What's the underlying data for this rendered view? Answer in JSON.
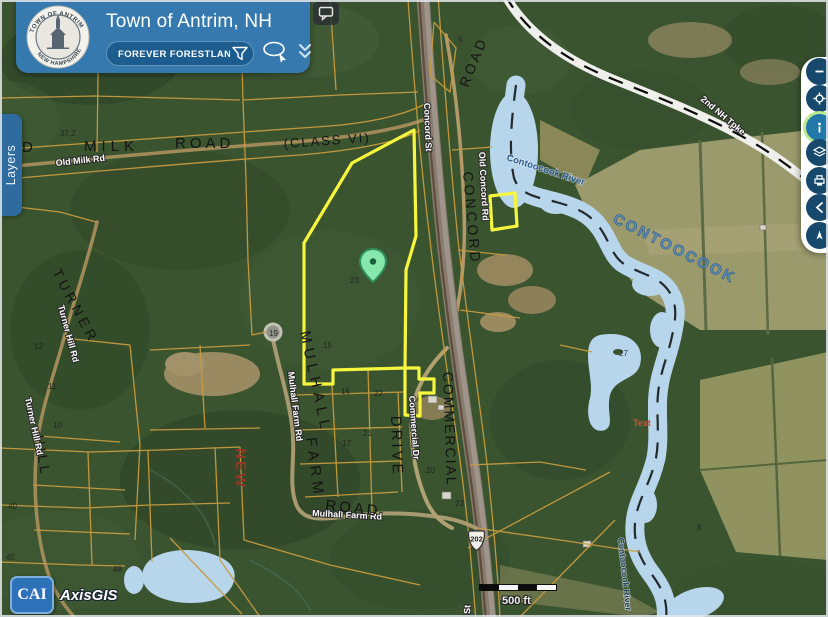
{
  "header": {
    "title": "Town of Antrim, NH",
    "seal": {
      "arc_top": "TOWN OF ANTRIM",
      "arc_bottom": "NEW HAMPSHIRE"
    },
    "search": {
      "value": "FOREVER FORESTLANDS"
    }
  },
  "tabs": {
    "layers": "Layers"
  },
  "icons": [
    "comment",
    "filter-funnel",
    "lasso-select",
    "double-chevron-down",
    "minus",
    "crosshair",
    "info",
    "layers",
    "print",
    "arrow-left",
    "compass",
    "location-pin"
  ],
  "branding": {
    "cai": "CAI",
    "product": "AxisGIS"
  },
  "scale_bar": {
    "label": "500 ft"
  },
  "route_shield": {
    "number": "202"
  },
  "map": {
    "adjacent_town": "ERING",
    "labels": {
      "old": {
        "text": "OLD"
      },
      "milk": {
        "text": "MILK"
      },
      "road_top": {
        "text": "ROAD"
      },
      "class_vi": {
        "text": "(CLASS VI)"
      },
      "old_milk_rd": {
        "text": "Old Milk Rd"
      },
      "concord_st": {
        "text": "Concord St"
      },
      "road_vert": {
        "text": "ROAD"
      },
      "old_concord_rd": {
        "text": "Old Concord Rd"
      },
      "concord_big": {
        "text": "CONCORD"
      },
      "contoocook_river_top": {
        "text": "Contoocook River"
      },
      "contoocook_big": {
        "text": "CONTOOCOOK"
      },
      "second_nh_tpke": {
        "text": "2nd NH Tpke"
      },
      "turner": {
        "text": "TURNER"
      },
      "hill": {
        "text": "HILL"
      },
      "turner_hill_rd_1": {
        "text": "Turner Hill Rd"
      },
      "turner_hill_rd_2": {
        "text": "Turner Hill Rd"
      },
      "mulhall": {
        "text": "MULHALL"
      },
      "farm": {
        "text": "FARM"
      },
      "mulhall_farm_rd_v": {
        "text": "Mulhall Farm Rd"
      },
      "mulhall_farm_rd_h": {
        "text": "Mulhall Farm Rd"
      },
      "new": {
        "text": "NEW"
      },
      "drive": {
        "text": "DRIVE"
      },
      "commercial_dr": {
        "text": "Commercial Dr"
      },
      "commercial": {
        "text": "COMMERCIAL"
      },
      "road_bottom": {
        "text": "ROAD"
      },
      "contoocook_river_bottom": {
        "text": "Contoocook River"
      },
      "text_note": {
        "text": "Text"
      },
      "st_bottom": {
        "text": "St"
      }
    },
    "parcel_numbers": [
      "5",
      "23",
      "19",
      "15",
      "16",
      "22",
      "21",
      "17",
      "20",
      "23",
      "27",
      "8",
      "48",
      "40",
      "45",
      "10",
      "11",
      "12",
      "37.2"
    ],
    "colors": {
      "selection_yellow": "#f6f63e",
      "parcel_line": "#c89b3f",
      "water": "#b7d6ec",
      "boundary_dash": "#0a0a0a",
      "header_blue": "#3579ae",
      "search_pill": "#1d5c8e",
      "layers_tab": "#2e6ca0",
      "tool_button": "#17496d",
      "highlight_ring": "#bdea8e",
      "pin_green": "#86e8ac"
    }
  }
}
